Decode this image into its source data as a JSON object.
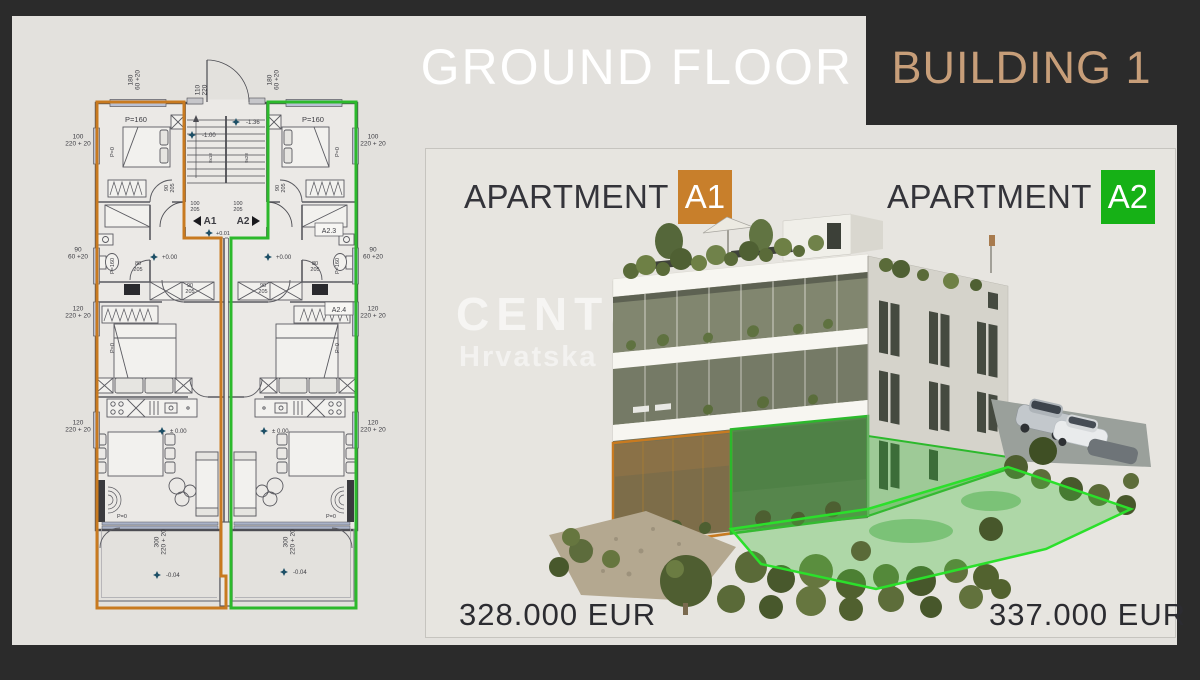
{
  "colors": {
    "frame": "#2b2b2b",
    "content": "#e3e1dd",
    "card": "#e7e5e0",
    "card-border": "#c6c4bf",
    "title": "#ffffff",
    "building-title": "#c79e79",
    "text-dark": "#34343a",
    "orange": "#c87a20",
    "green": "#2cb92c",
    "green-bright": "#2be02b",
    "badge-orange": "#c87f2b",
    "badge-green": "#16b116",
    "plan-line": "#55555a",
    "window": "#b9c0d4"
  },
  "header": {
    "title": "GROUND FLOOR",
    "building": "BUILDING 1"
  },
  "card": {
    "apartments": [
      {
        "label": "APARTMENT",
        "code": "A1",
        "price": "328.000 EUR"
      },
      {
        "label": "APARTMENT",
        "code": "A2",
        "price": "337.000 EUR"
      }
    ],
    "watermark": {
      "line1": "CENTURY 21",
      "line2": "Hrvatska"
    }
  },
  "floor_plan": {
    "unit_left": "A1",
    "unit_right": "A2",
    "labels": [
      {
        "t": "180\n60 +20",
        "x": 86,
        "y": 28,
        "r": -90
      },
      {
        "t": "110\n220",
        "x": 153,
        "y": 38,
        "r": -90
      },
      {
        "t": "180\n60 +20",
        "x": 225,
        "y": 28,
        "r": -90
      },
      {
        "t": "P=160",
        "x": 86,
        "y": 70,
        "s": 7.5
      },
      {
        "t": "P=160",
        "x": 263,
        "y": 70,
        "s": 7.5
      },
      {
        "t": "100\n220 + 20",
        "x": 28,
        "y": 90
      },
      {
        "t": "100\n220 + 20",
        "x": 323,
        "y": 90
      },
      {
        "t": "-1.00",
        "x": 152,
        "y": 85,
        "s": 6,
        "m": 1,
        "a": "start",
        "mx": -10
      },
      {
        "t": "-1.36",
        "x": 196,
        "y": 72,
        "s": 6,
        "m": 1,
        "a": "start",
        "mx": -10
      },
      {
        "t": "8x18",
        "x": 162,
        "y": 106,
        "s": 4.5,
        "r": -90
      },
      {
        "t": "9x28",
        "x": 198,
        "y": 106,
        "s": 4.5,
        "r": -90
      },
      {
        "t": "90\n205",
        "x": 121,
        "y": 136,
        "s": 5.5,
        "r": -90
      },
      {
        "t": "90\n205",
        "x": 232,
        "y": 136,
        "s": 5.5,
        "r": -90
      },
      {
        "t": "100\n205",
        "x": 145,
        "y": 156,
        "s": 5.5
      },
      {
        "t": "100\n205",
        "x": 188,
        "y": 156,
        "s": 5.5
      },
      {
        "t": "A1",
        "x": 160,
        "y": 172,
        "s": 10,
        "w": "bold"
      },
      {
        "t": "A2",
        "x": 193,
        "y": 172,
        "s": 10,
        "w": "bold"
      },
      {
        "t": "+0.01",
        "x": 166,
        "y": 183,
        "s": 5.5,
        "m": 1,
        "a": "start",
        "mx": -7
      },
      {
        "t": "+0.00",
        "x": 112,
        "y": 207,
        "s": 6,
        "m": 1,
        "a": "start",
        "mx": -8
      },
      {
        "t": "+0.00",
        "x": 226,
        "y": 207,
        "s": 6,
        "m": 1,
        "a": "start",
        "mx": -8
      },
      {
        "t": "80\n205",
        "x": 88,
        "y": 216,
        "s": 5.5
      },
      {
        "t": "80\n205",
        "x": 265,
        "y": 216,
        "s": 5.5
      },
      {
        "t": "A2.3",
        "x": 279,
        "y": 181,
        "s": 7,
        "box": 1
      },
      {
        "t": "A2.4",
        "x": 289,
        "y": 260,
        "s": 7,
        "box": 1
      },
      {
        "t": "90\n60 +20",
        "x": 28,
        "y": 203
      },
      {
        "t": "90\n60 +20",
        "x": 323,
        "y": 203
      },
      {
        "t": "90\n205",
        "x": 140,
        "y": 238,
        "s": 5.5
      },
      {
        "t": "90\n205",
        "x": 213,
        "y": 238,
        "s": 5.5
      },
      {
        "t": "120\n220 + 20",
        "x": 28,
        "y": 262
      },
      {
        "t": "120\n220 + 20",
        "x": 323,
        "y": 262
      },
      {
        "t": "120\n220 + 20",
        "x": 28,
        "y": 376
      },
      {
        "t": "120\n220 + 20",
        "x": 323,
        "y": 376
      },
      {
        "t": "± 0.00",
        "x": 120,
        "y": 381,
        "s": 6,
        "m": 1,
        "a": "start",
        "mx": -8
      },
      {
        "t": "± 0.00",
        "x": 222,
        "y": 381,
        "s": 6,
        "m": 1,
        "a": "start",
        "mx": -8
      },
      {
        "t": "P=0",
        "x": 64,
        "y": 100,
        "s": 5.5,
        "r": -90
      },
      {
        "t": "P=0",
        "x": 289,
        "y": 100,
        "s": 5.5,
        "r": -90
      },
      {
        "t": "P=160",
        "x": 64,
        "y": 214,
        "s": 5.5,
        "r": -90
      },
      {
        "t": "P=160",
        "x": 289,
        "y": 214,
        "s": 5.5,
        "r": -90
      },
      {
        "t": "P=0",
        "x": 64,
        "y": 296,
        "s": 5.5,
        "r": -90
      },
      {
        "t": "P=0",
        "x": 289,
        "y": 296,
        "s": 5.5,
        "r": -90
      },
      {
        "t": "P=0",
        "x": 72,
        "y": 466,
        "s": 5.5
      },
      {
        "t": "P=0",
        "x": 281,
        "y": 466,
        "s": 5.5
      },
      {
        "t": "300\n220 + 20",
        "x": 112,
        "y": 490,
        "r": -90
      },
      {
        "t": "300\n220 + 20",
        "x": 241,
        "y": 490,
        "r": -90
      },
      {
        "t": "-0.04",
        "x": 116,
        "y": 525,
        "s": 6,
        "m": 1,
        "a": "start",
        "mx": -9
      },
      {
        "t": "-0.04",
        "x": 243,
        "y": 522,
        "s": 6,
        "m": 1,
        "a": "start",
        "mx": -9
      }
    ]
  }
}
